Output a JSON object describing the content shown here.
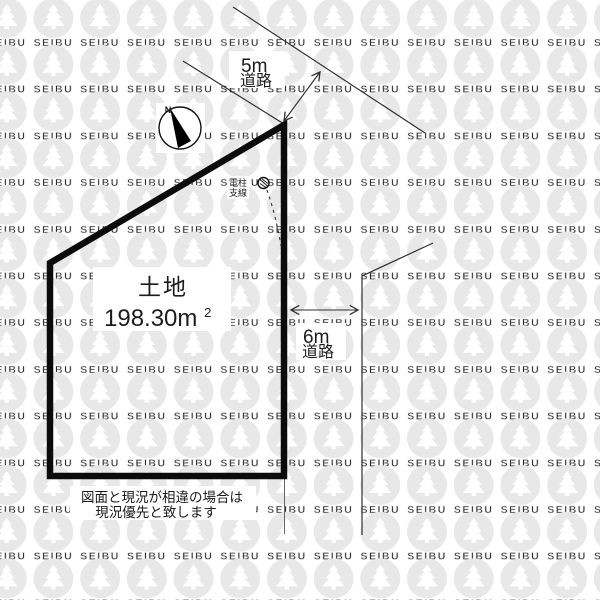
{
  "watermark": {
    "brand": "SEIBU"
  },
  "compass": {
    "north_label": "N"
  },
  "roads": {
    "top": {
      "width_label": "5m",
      "type_label": "道路"
    },
    "right": {
      "width_label": "6m",
      "type_label": "道路"
    }
  },
  "plot": {
    "label": "土地",
    "area_main": "198.30m",
    "area_sup": "2"
  },
  "pole": {
    "line1": "電柱",
    "line2": "支線"
  },
  "disclaimer": {
    "line1": "図面と現況が相違の場合は",
    "line2": "現況優先と致します"
  },
  "colors": {
    "watermark_gray": "#e8e8e8",
    "line_dark": "#2f2f2f",
    "plot_border": "#0b0b0b",
    "text": "#1c1c1c"
  }
}
